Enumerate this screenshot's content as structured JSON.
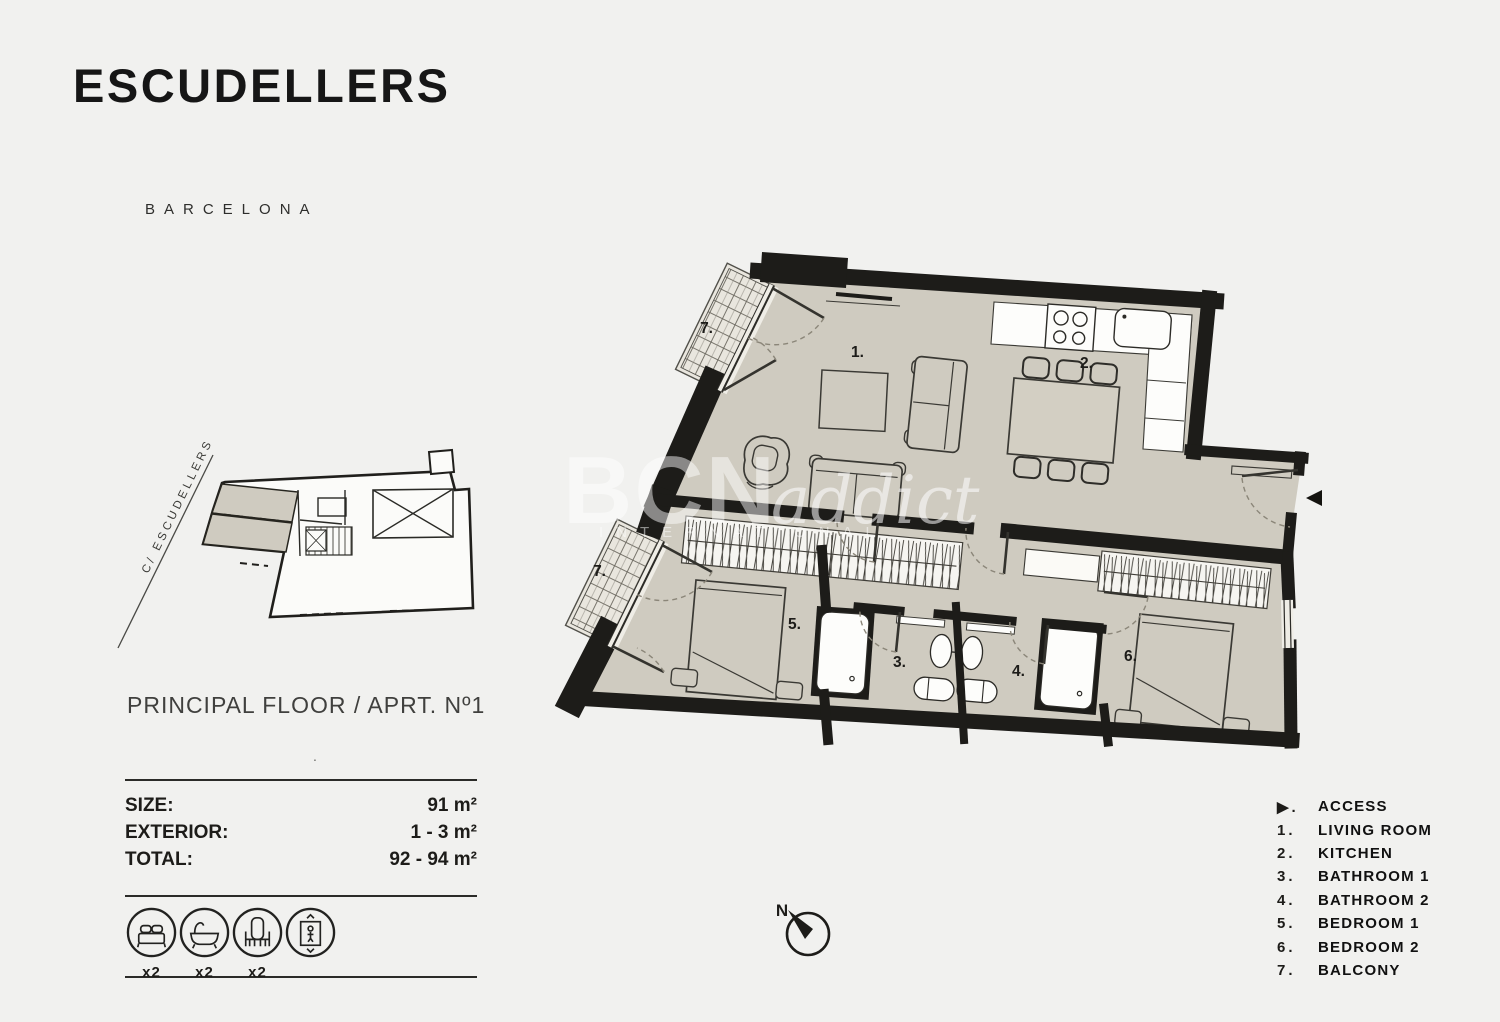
{
  "header": {
    "title": "ESCUDELLERS",
    "city": "BARCELONA"
  },
  "location_map": {
    "street_label": "C/ ESCUDELLERS"
  },
  "floor_title": "PRINCIPAL FLOOR /  APRT. Nº1",
  "stray_mark": ".",
  "stats": {
    "size_label": "SIZE:",
    "size_value": "91 m²",
    "exterior_label": "EXTERIOR:",
    "exterior_value": "1 - 3 m²",
    "total_label": "TOTAL:",
    "total_value": "92 - 94 m²"
  },
  "amenities": {
    "items": [
      {
        "icon": "bed-icon",
        "count": "x2"
      },
      {
        "icon": "bathtub-icon",
        "count": "x2"
      },
      {
        "icon": "chair-icon",
        "count": "x2"
      },
      {
        "icon": "elevator-icon",
        "count": ""
      }
    ]
  },
  "plan": {
    "labels": {
      "living": "1.",
      "kitchen": "2.",
      "bath1": "3.",
      "bath2": "4.",
      "bed1": "5.",
      "bed2": "6.",
      "balcony_top": "7.",
      "balcony_bottom": "7."
    },
    "compass_label": "N"
  },
  "legend": {
    "items": [
      {
        "marker": "▶.",
        "label": "ACCESS"
      },
      {
        "marker": "1.",
        "label": "LIVING ROOM"
      },
      {
        "marker": "2.",
        "label": "KITCHEN"
      },
      {
        "marker": "3.",
        "label": "BATHROOM 1"
      },
      {
        "marker": "4.",
        "label": "BATHROOM 2"
      },
      {
        "marker": "5.",
        "label": "BEDROOM 1"
      },
      {
        "marker": "6.",
        "label": "BEDROOM 2"
      },
      {
        "marker": "7.",
        "label": "BALCONY"
      }
    ]
  },
  "watermark": {
    "brand_bold": "BCN",
    "brand_script": "addict",
    "tagline": "INTERNATIONAL"
  },
  "colors": {
    "floor": "#cfcbc0",
    "wall": "#1d1c19",
    "background": "#f1f1ef"
  }
}
